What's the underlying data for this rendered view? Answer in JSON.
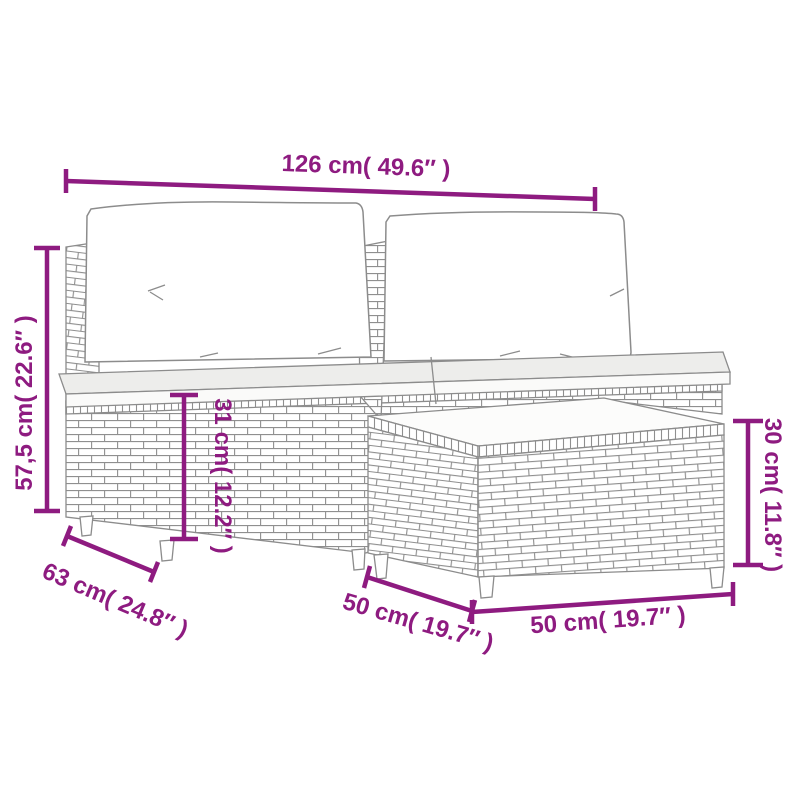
{
  "diagram": {
    "type": "product-dimension-diagram",
    "subject": "poly rattan garden lounge set: two armless sofa modules with back and seat cushions, plus ottoman footstool table",
    "background": "#ffffff"
  },
  "colors": {
    "dimension_accent": "#8e1b80",
    "line_art_outline": "#8c8c8c",
    "cushion_fill": "#ffffff",
    "seat_top_fill": "#ededeb"
  },
  "dimensions": {
    "total_width": "126 cm( 49.6″ )",
    "total_height": "57,5 cm( 22.6″ )",
    "seat_height": "31 cm( 12.2″ )",
    "ottoman_height": "30 cm( 11.8″ )",
    "sofa_depth": "63 cm( 24.8″ )",
    "ottoman_depth": "50 cm( 19.7″ )",
    "ottoman_width": "50 cm( 19.7″ )"
  }
}
